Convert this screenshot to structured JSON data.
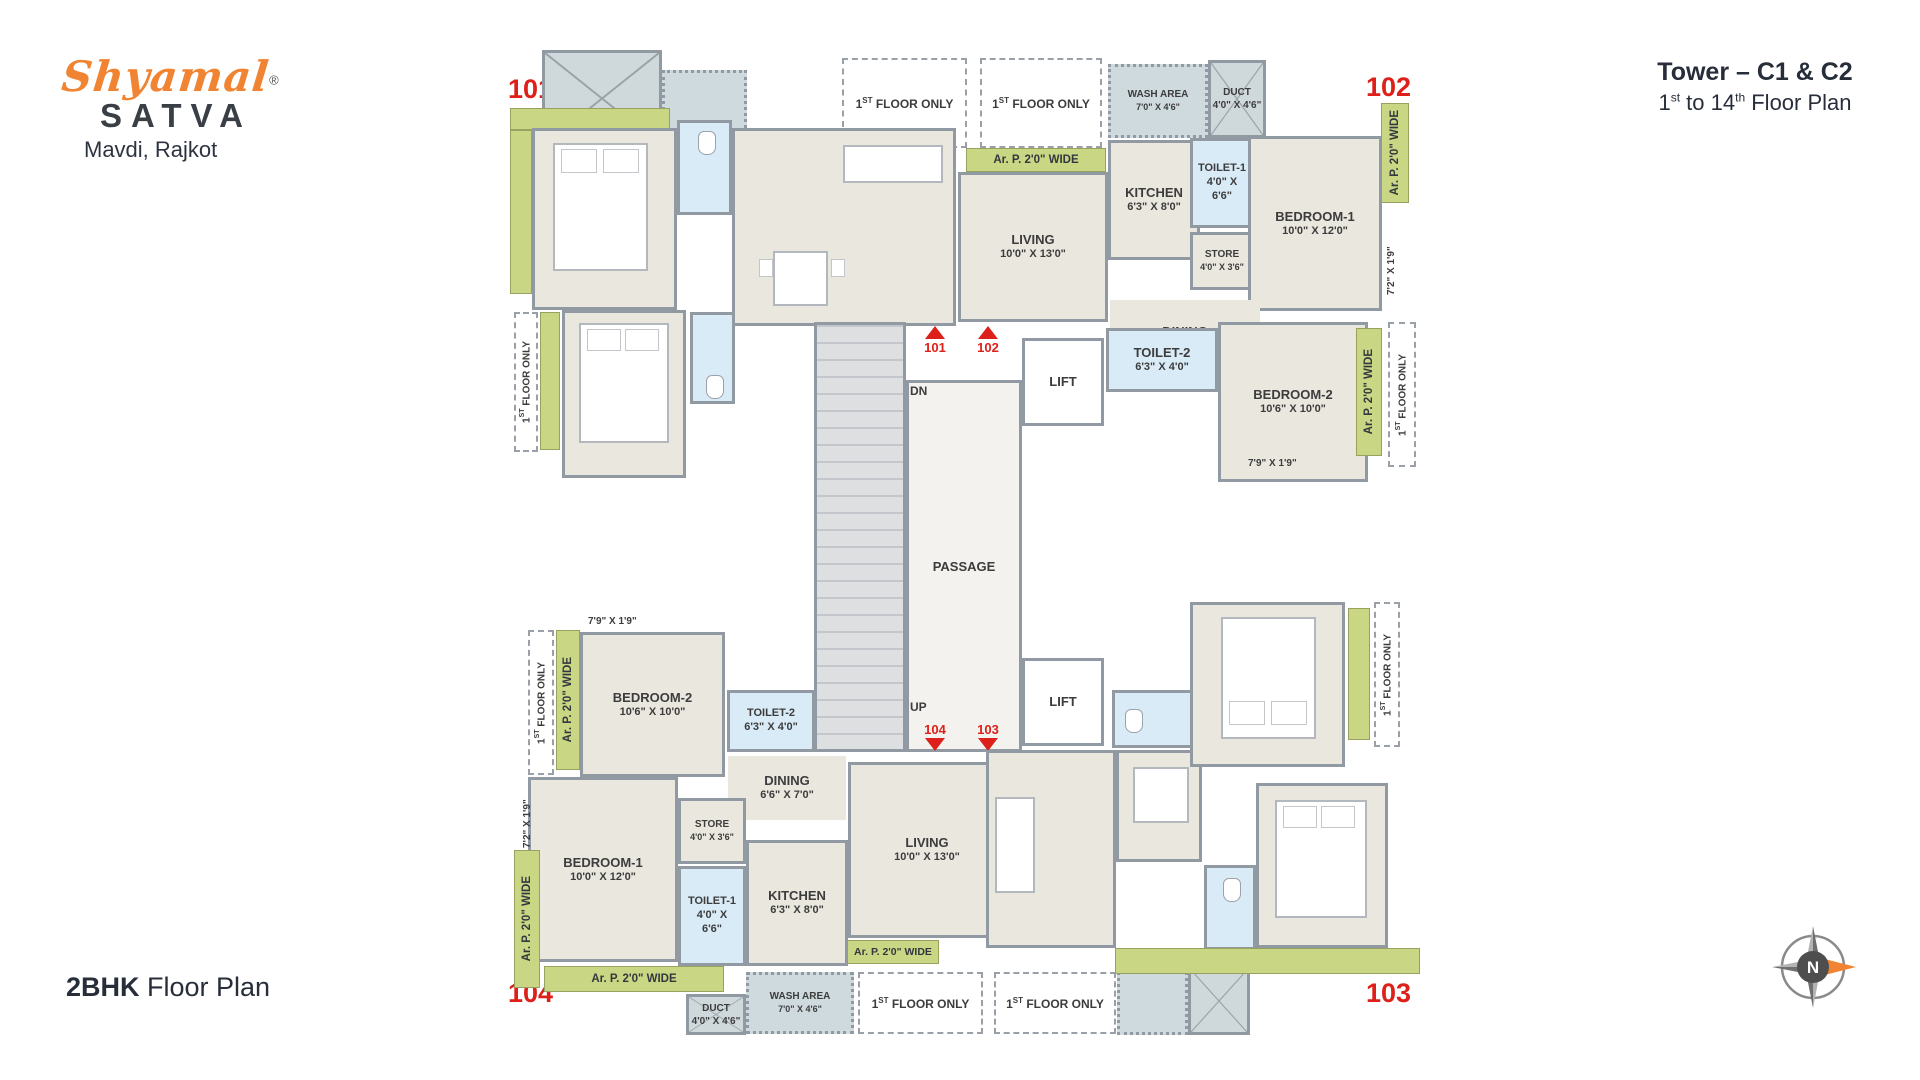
{
  "brand": {
    "script": "Shyamal",
    "reg": "®",
    "name": "SATVA",
    "location": "Mavdi, Rajkot",
    "accent_color": "#F08433",
    "dark_color": "#3A3F46"
  },
  "header": {
    "title": "Tower – C1 & C2",
    "subtitle": {
      "a": "1",
      "a_sup": "st",
      "b": " to 14",
      "b_sup": "th",
      "c": " Floor Plan"
    }
  },
  "footer": {
    "type": "2BHK",
    "rest": " Floor Plan"
  },
  "compass": {
    "north": "N"
  },
  "unit_numbers": {
    "u101": "101",
    "u102": "102",
    "u103": "103",
    "u104": "104"
  },
  "core": {
    "passage": "PASSAGE",
    "lift": "LIFT",
    "dn": "DN",
    "up": "UP"
  },
  "rooms": {
    "living": {
      "name": "LIVING",
      "dim": "10'0\" X 13'0\""
    },
    "kitchen": {
      "name": "KITCHEN",
      "dim": "6'3\" X 8'0\""
    },
    "toilet1": {
      "name": "TOILET-1",
      "dim1": "4'0\" X",
      "dim2": "6'6\""
    },
    "store": {
      "name": "STORE",
      "dim": "4'0\" X 3'6\""
    },
    "bedroom1": {
      "name": "BEDROOM-1",
      "dim": "10'0\" X 12'0\""
    },
    "dining": {
      "name": "DINING",
      "dim": "6'6\" X 7'0\""
    },
    "toilet2": {
      "name": "TOILET-2",
      "dim": "6'3\" X 4'0\""
    },
    "bedroom2": {
      "name": "BEDROOM-2",
      "dim": "10'6\" X 10'0\""
    },
    "wash": {
      "name": "WASH AREA",
      "dim": "7'0\" X 4'6\""
    },
    "duct": {
      "name": "DUCT",
      "dim": "4'0\" X 4'6\""
    }
  },
  "annotations": {
    "floor_only": {
      "num": "1",
      "sup": "ST",
      "rest": " FLOOR ONLY"
    },
    "arp": "Ar. P. 2'0\" WIDE",
    "dim_72_19": "7'2\" X 1'9\"",
    "dim_79_19": "7'9\" X 1'9\""
  },
  "colors": {
    "marker_red": "#DD2019",
    "green_strip": "#C9D683",
    "toilet_blue": "#D9EBF7",
    "wall_gray": "#9199A3",
    "floor_beige": "#EAE7DF"
  }
}
